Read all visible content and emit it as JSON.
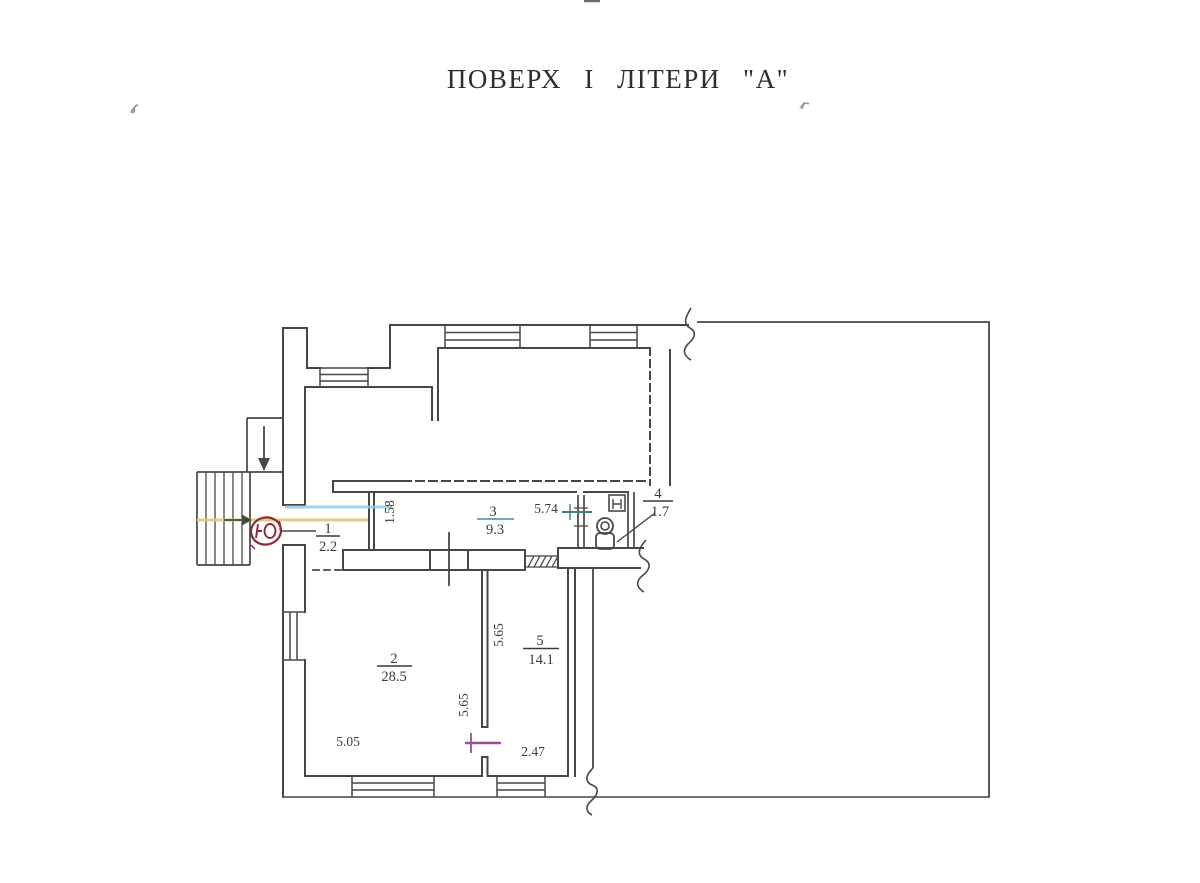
{
  "title": "ПОВЕРХ І ЛІТЕРИ \"А\"",
  "rooms": {
    "r1": {
      "number": "1",
      "area": "2.2"
    },
    "r2": {
      "number": "2",
      "area": "28.5"
    },
    "r3": {
      "number": "3",
      "area": "9.3"
    },
    "r4": {
      "number": "4",
      "area": "1.7"
    },
    "r5": {
      "number": "5",
      "area": "14.1"
    }
  },
  "dimensions": {
    "entry_width": "1.58",
    "corridor_length": "5.74",
    "room5_depth": "5.65",
    "room2_depth": "5.65",
    "room2_width": "5.05",
    "room5_width": "2.47"
  },
  "colors": {
    "line": "#474747",
    "highlight_yellow": "#d9c87a",
    "highlight_cyan": "#8fcbe0",
    "stamp_maroon": "#8a2a3a",
    "check_purple": "#9b4f96",
    "tick_teal": "#3f7d78",
    "fraction_cyan": "#6aa7c8"
  }
}
